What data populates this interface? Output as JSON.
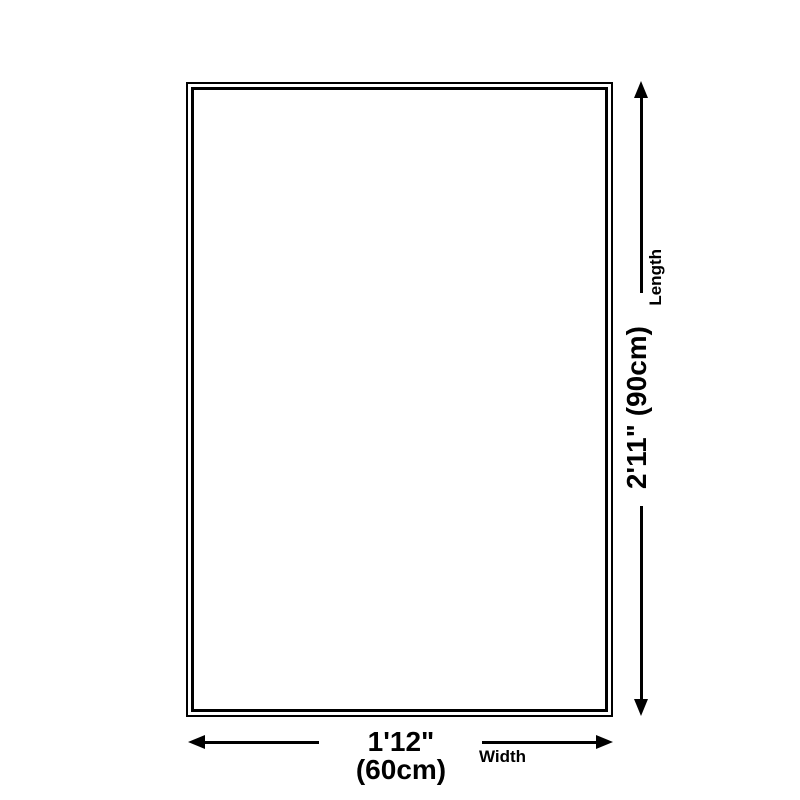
{
  "page": {
    "background_color": "#ffffff",
    "foreground_color": "#000000"
  },
  "diagram": {
    "kind": "product-size-diagram",
    "shape": "rectangle-double-outline",
    "outline_color": "#000000",
    "fill_color": "#ffffff",
    "length": {
      "value": "2'11\" (90cm)",
      "label": "Length"
    },
    "width": {
      "value": "1'12\" (60cm)",
      "label": "Width"
    }
  }
}
